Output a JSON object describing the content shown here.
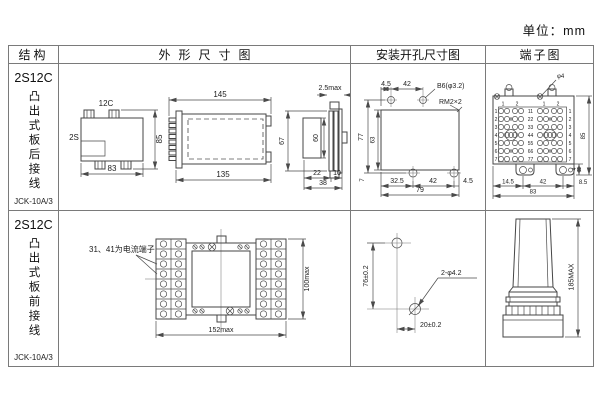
{
  "unit": "单位：mm",
  "headers": {
    "c1": "结构",
    "c2": "外形尺寸图",
    "c3": "安装开孔尺寸图",
    "c4": "端子图"
  },
  "row1": {
    "model": "2S12C",
    "type": "凸出式板后接线",
    "code": "JCK-10A/3",
    "outline": {
      "front_top": "12C",
      "front_left": "2S",
      "front_w": "83",
      "front_h": "85",
      "side_top": "145",
      "side_bottom": "135",
      "edge_top": "2.5max",
      "edge_h_outer": "67",
      "edge_h_inner": "60",
      "edge_d1": "22",
      "edge_d2": "10",
      "edge_d3": "38"
    },
    "install": {
      "t1": "4.5",
      "t2": "42",
      "hole_callout": "B6(φ3.2)",
      "screw_callout": "RM2×2",
      "l1": "77",
      "l2": "63",
      "b0": "7",
      "b1": "32.5",
      "b2": "42",
      "b3": "4.5",
      "total": "79"
    },
    "terminal": {
      "callout": "φ4",
      "cols": [
        "1",
        "2",
        "1",
        "2"
      ],
      "rows_l": [
        "1",
        "2",
        "3",
        "4",
        "5",
        "6",
        "7"
      ],
      "rows_m": [
        "11",
        "22",
        "33",
        "44",
        "55",
        "66",
        "77"
      ],
      "rows_r": [
        "1",
        "2",
        "3",
        "4",
        "5",
        "6",
        "7"
      ],
      "b1": "14.5",
      "b2": "42",
      "b3": "8.5",
      "total": "83",
      "h": "85",
      "ear": "4"
    }
  },
  "row2": {
    "model": "2S12C",
    "type": "凸出式板前接线",
    "code": "JCK-10A/3",
    "outline": {
      "note": "31、41为电流端子",
      "w": "152max",
      "h": "100max"
    },
    "install": {
      "v": "76±0.2",
      "holes": "2-φ4.2",
      "h": "20±0.2"
    },
    "terminal": {
      "h": "185MAX"
    }
  }
}
